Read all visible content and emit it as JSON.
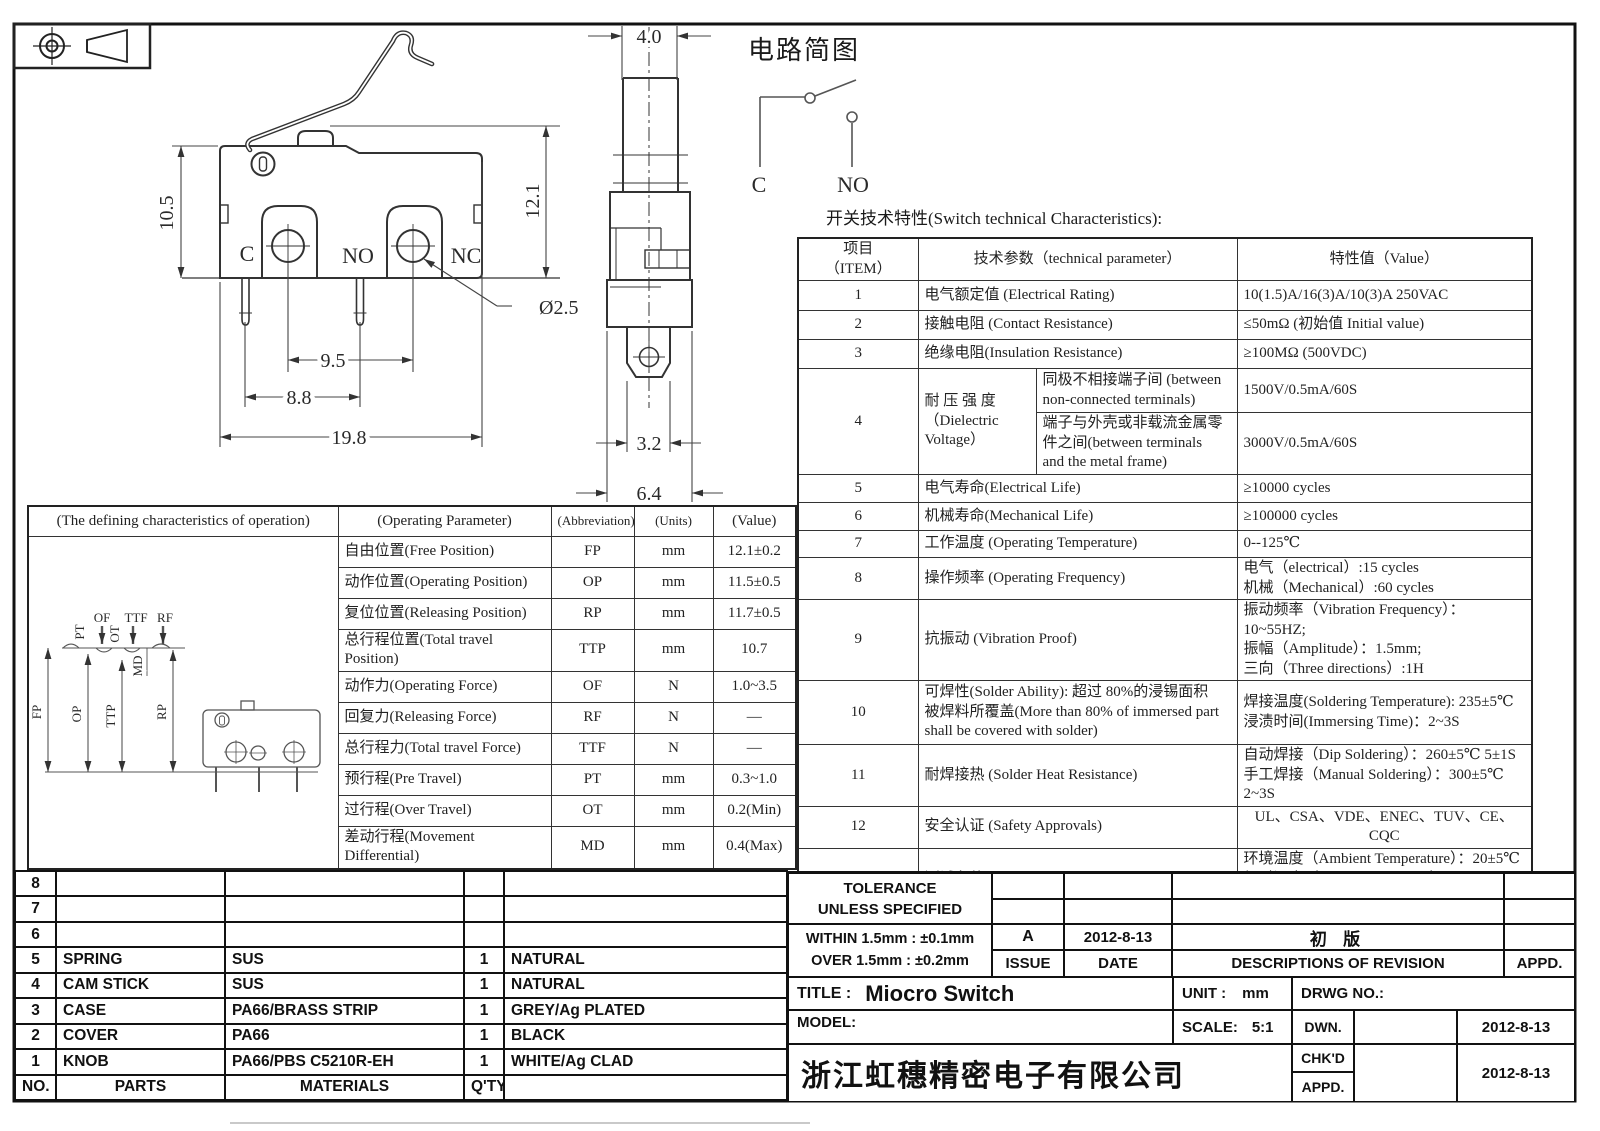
{
  "drawing": {
    "heading": "开关技术特性(Switch technical Characteristics):",
    "front": {
      "h1": "10.5",
      "h2": "12.1",
      "hole": "Ø2.5",
      "p1": "9.5",
      "p2": "8.8",
      "w": "19.8",
      "c": "C",
      "no": "NO",
      "nc": "NC"
    },
    "side": {
      "w": "4.0",
      "tab": "3.2",
      "body": "6.4"
    },
    "circuit": {
      "title": "电路简图",
      "c": "C",
      "no": "NO"
    },
    "travel": {
      "labels": [
        "PT",
        "OF",
        "OT",
        "TTF",
        "RF",
        "MD"
      ],
      "axes": [
        "FP",
        "OP",
        "TTP",
        "RP"
      ]
    }
  },
  "characteristics": {
    "headers": {
      "item": "项目\n（ITEM）",
      "param": "技术参数（technical parameter）",
      "value": "特性值（Value）"
    },
    "rows": [
      {
        "no": "1",
        "param": "电气额定值 (Electrical Rating)",
        "value": "10(1.5)A/16(3)A/10(3)A  250VAC"
      },
      {
        "no": "2",
        "param": "接触电阻 (Contact  Resistance)",
        "value": "≤50mΩ (初始值 Initial value)"
      },
      {
        "no": "3",
        "param": "绝缘电阻(Insulation Resistance)",
        "value": "≥100MΩ (500VDC)"
      },
      {
        "no": "4",
        "param_main": "耐 压 强 度\n（Dielectric\nVoltage）",
        "sub": [
          {
            "param": "同极不相接端子间 (between\nnon-connected terminals)",
            "value": "1500V/0.5mA/60S"
          },
          {
            "param": "端子与外壳或非载流金属零\n件之间(between terminals\nand the metal frame)",
            "value": "3000V/0.5mA/60S"
          }
        ]
      },
      {
        "no": "5",
        "param": "电气寿命(Electrical Life)",
        "value": "≥10000 cycles"
      },
      {
        "no": "6",
        "param": "机械寿命(Mechanical Life)",
        "value": "≥100000 cycles"
      },
      {
        "no": "7",
        "param": "工作温度 (Operating Temperature)",
        "value": "0--125℃"
      },
      {
        "no": "8",
        "param": "操作频率 (Operating Frequency)",
        "value": "电气（electrical）:15 cycles\n机械（Mechanical）:60 cycles"
      },
      {
        "no": "9",
        "param": "抗振动 (Vibration Proof)",
        "value": "振动频率（Vibration Frequency）：10~55HZ;\n振幅（Amplitude）：1.5mm;\n三向（Three directions）:1H"
      },
      {
        "no": "10",
        "param": "可焊性(Solder Ability): 超过 80%的浸锡面积\n被焊料所覆盖(More than 80% of immersed part\nshall be covered with solder)",
        "value": "焊接温度(Soldering Temperature): 235±5℃\n浸渍时间(Immersing Time)：2~3S"
      },
      {
        "no": "11",
        "param": "耐焊接热 (Solder Heat Resistance)",
        "value": "自动焊接（Dip Soldering）：260±5℃ 5±1S\n手工焊接（Manual Soldering）：300±5℃ 2~3S"
      },
      {
        "no": "12",
        "param": "安全认证 (Safety Approvals)",
        "value": "UL、CSA、VDE、ENEC、TUV、CE、CQC"
      },
      {
        "no": "13",
        "param": "测试条件 (Test Conditions)",
        "value": "环境温度（Ambient Temperature）：20±5℃\n相对湿度（Relative Humidity）：65±5%RH\n大气压（Air Pressure）：86~106KPa"
      }
    ]
  },
  "operating": {
    "headers": [
      "(The defining characteristics of operation)",
      "(Operating Parameter)",
      "(Abbreviation)",
      "(Units)",
      "(Value)"
    ],
    "rows": [
      {
        "param": "自由位置(Free Position)",
        "abbr": "FP",
        "units": "mm",
        "value": "12.1±0.2"
      },
      {
        "param": "动作位置(Operating Position)",
        "abbr": "OP",
        "units": "mm",
        "value": "11.5±0.5"
      },
      {
        "param": "复位位置(Releasing Position)",
        "abbr": "RP",
        "units": "mm",
        "value": "11.7±0.5"
      },
      {
        "param": "总行程位置(Total travel Position)",
        "abbr": "TTP",
        "units": "mm",
        "value": "10.7"
      },
      {
        "param": "动作力(Operating Force)",
        "abbr": "OF",
        "units": "N",
        "value": "1.0~3.5"
      },
      {
        "param": "回复力(Releasing Force)",
        "abbr": "RF",
        "units": "N",
        "value": "—"
      },
      {
        "param": "总行程力(Total travel Force)",
        "abbr": "TTF",
        "units": "N",
        "value": "—"
      },
      {
        "param": "预行程(Pre Travel)",
        "abbr": "PT",
        "units": "mm",
        "value": "0.3~1.0"
      },
      {
        "param": "过行程(Over Travel)",
        "abbr": "OT",
        "units": "mm",
        "value": "0.2(Min)"
      },
      {
        "param": "差动行程(Movement Differential)",
        "abbr": "MD",
        "units": "mm",
        "value": "0.4(Max)"
      }
    ]
  },
  "parts_table": {
    "rows": [
      {
        "no": "8",
        "part": "",
        "material": "",
        "qty": "",
        "color": ""
      },
      {
        "no": "7",
        "part": "",
        "material": "",
        "qty": "",
        "color": ""
      },
      {
        "no": "6",
        "part": "",
        "material": "",
        "qty": "",
        "color": ""
      },
      {
        "no": "5",
        "part": "SPRING",
        "material": "SUS",
        "qty": "1",
        "color": "NATURAL"
      },
      {
        "no": "4",
        "part": "CAM STICK",
        "material": "SUS",
        "qty": "1",
        "color": "NATURAL"
      },
      {
        "no": "3",
        "part": "CASE",
        "material": "PA66/BRASS STRIP",
        "qty": "1",
        "color": "GREY/Ag PLATED"
      },
      {
        "no": "2",
        "part": "COVER",
        "material": "PA66",
        "qty": "1",
        "color": "BLACK"
      },
      {
        "no": "1",
        "part": "KNOB",
        "material": "PA66/PBS C5210R-EH",
        "qty": "1",
        "color": "WHITE/Ag CLAD"
      }
    ],
    "footer": {
      "no": "NO.",
      "parts": "PARTS",
      "materials": "MATERIALS",
      "qty": "Q'TY",
      "color": ""
    }
  },
  "title_block": {
    "tolerance_line1": "TOLERANCE",
    "tolerance_line2": "UNLESS  SPECIFIED",
    "within": "WITHIN 1.5mm : ±0.1mm",
    "over": "OVER 1.5mm : ±0.2mm",
    "rev": {
      "issue": "A",
      "date": "2012-8-13",
      "desc": "初  版"
    },
    "rev_headers": {
      "issue": "ISSUE",
      "date": "DATE",
      "desc": "DESCRIPTIONS OF REVISION",
      "appd": "APPD."
    },
    "title_label": "TITLE :",
    "title": "Miocro Switch",
    "unit_label": "UNIT :",
    "unit": "mm",
    "drwg_label": "DRWG NO.:",
    "model_label": "MODEL:",
    "scale_label": "SCALE:",
    "scale": "5:1",
    "dwn": "DWN.",
    "chkd": "CHK'D",
    "appd": "APPD.",
    "dwn_date": "2012-8-13",
    "chk_date": "2012-8-13",
    "company": "浙江虹穗精密电子有限公司"
  }
}
